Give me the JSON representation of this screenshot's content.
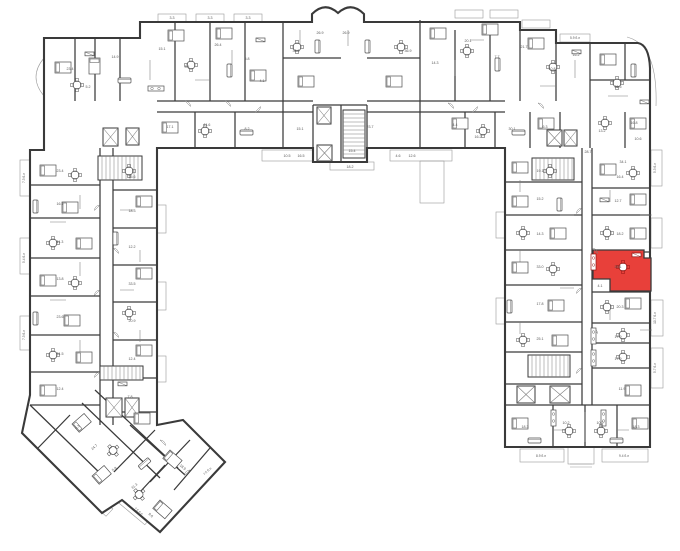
{
  "plan": {
    "name": "floor-plan-level",
    "background": "#ffffff",
    "wall_color": "#3a3a3a",
    "partition_color": "#7c7c7c",
    "thin_color": "#9a9a9a",
    "furniture_color": "#4f4f4f",
    "label_color": "#565656",
    "highlight_color": "#e8403a",
    "highlight_dark_color": "#8f1210",
    "highlighted_unit": {
      "wing": "right",
      "area_label": "26.1",
      "second_label": "4.1"
    }
  },
  "area_labels": [
    {
      "x": 115,
      "y": 58,
      "t": "14.9"
    },
    {
      "x": 70,
      "y": 70,
      "t": "23.4"
    },
    {
      "x": 88,
      "y": 88,
      "t": "5.2"
    },
    {
      "x": 162,
      "y": 50,
      "t": "15.1"
    },
    {
      "x": 187,
      "y": 68,
      "t": "3.4"
    },
    {
      "x": 218,
      "y": 46,
      "t": "26.4"
    },
    {
      "x": 247,
      "y": 60,
      "t": "5.8"
    },
    {
      "x": 262,
      "y": 82,
      "t": "4.1"
    },
    {
      "x": 296,
      "y": 52,
      "t": "36.9"
    },
    {
      "x": 320,
      "y": 34,
      "t": "26.9"
    },
    {
      "x": 346,
      "y": 34,
      "t": "26.9"
    },
    {
      "x": 408,
      "y": 52,
      "t": "36.9"
    },
    {
      "x": 435,
      "y": 64,
      "t": "14.3"
    },
    {
      "x": 468,
      "y": 42,
      "t": "20.1"
    },
    {
      "x": 497,
      "y": 58,
      "t": "7.7"
    },
    {
      "x": 524,
      "y": 48,
      "t": "21.7"
    },
    {
      "x": 552,
      "y": 70,
      "t": "10.8"
    },
    {
      "x": 576,
      "y": 56,
      "t": "16.2"
    },
    {
      "x": 618,
      "y": 88,
      "t": "36.5"
    },
    {
      "x": 170,
      "y": 128,
      "t": "17.1"
    },
    {
      "x": 207,
      "y": 126,
      "t": "11.6"
    },
    {
      "x": 247,
      "y": 130,
      "t": "8.2"
    },
    {
      "x": 300,
      "y": 130,
      "t": "15.1"
    },
    {
      "x": 370,
      "y": 128,
      "t": "23.7"
    },
    {
      "x": 352,
      "y": 152,
      "t": "15.4"
    },
    {
      "x": 350,
      "y": 168,
      "t": "18.2"
    },
    {
      "x": 455,
      "y": 126,
      "t": "4.4"
    },
    {
      "x": 478,
      "y": 138,
      "t": "16.2"
    },
    {
      "x": 512,
      "y": 130,
      "t": "30.1"
    },
    {
      "x": 545,
      "y": 128,
      "t": "6.3"
    },
    {
      "x": 602,
      "y": 132,
      "t": "13.2"
    },
    {
      "x": 634,
      "y": 124,
      "t": "16.8"
    },
    {
      "x": 638,
      "y": 140,
      "t": "10.6"
    },
    {
      "x": 287,
      "y": 157,
      "t": "10.5"
    },
    {
      "x": 301,
      "y": 157,
      "t": "16.5"
    },
    {
      "x": 398,
      "y": 157,
      "t": "4.6"
    },
    {
      "x": 412,
      "y": 157,
      "t": "12.6"
    },
    {
      "x": 60,
      "y": 172,
      "t": "23.4"
    },
    {
      "x": 60,
      "y": 205,
      "t": "16.1"
    },
    {
      "x": 60,
      "y": 243,
      "t": "11.3"
    },
    {
      "x": 60,
      "y": 280,
      "t": "13.8"
    },
    {
      "x": 60,
      "y": 318,
      "t": "23.6"
    },
    {
      "x": 60,
      "y": 355,
      "t": "31.5"
    },
    {
      "x": 60,
      "y": 390,
      "t": "12.4"
    },
    {
      "x": 132,
      "y": 178,
      "t": "15.6"
    },
    {
      "x": 132,
      "y": 212,
      "t": "18.3"
    },
    {
      "x": 132,
      "y": 248,
      "t": "12.2"
    },
    {
      "x": 132,
      "y": 285,
      "t": "33.5"
    },
    {
      "x": 132,
      "y": 322,
      "t": "20.9"
    },
    {
      "x": 132,
      "y": 360,
      "t": "12.4"
    },
    {
      "x": 130,
      "y": 398,
      "t": "7.8"
    },
    {
      "x": 540,
      "y": 172,
      "t": "19.1"
    },
    {
      "x": 540,
      "y": 200,
      "t": "15.2"
    },
    {
      "x": 540,
      "y": 235,
      "t": "14.3"
    },
    {
      "x": 540,
      "y": 268,
      "t": "33.0"
    },
    {
      "x": 540,
      "y": 305,
      "t": "17.8"
    },
    {
      "x": 540,
      "y": 340,
      "t": "25.1"
    },
    {
      "x": 588,
      "y": 153,
      "t": "28.7"
    },
    {
      "x": 623,
      "y": 163,
      "t": "34.1"
    },
    {
      "x": 620,
      "y": 178,
      "t": "16.4"
    },
    {
      "x": 618,
      "y": 202,
      "t": "12.7"
    },
    {
      "x": 620,
      "y": 235,
      "t": "18.2"
    },
    {
      "x": 618,
      "y": 268,
      "t": "26.1",
      "c": "h"
    },
    {
      "x": 600,
      "y": 287,
      "t": "4.1",
      "c": "h"
    },
    {
      "x": 620,
      "y": 308,
      "t": "20.3"
    },
    {
      "x": 618,
      "y": 338,
      "t": "17.9"
    },
    {
      "x": 618,
      "y": 360,
      "t": "17.9"
    },
    {
      "x": 622,
      "y": 390,
      "t": "11.9"
    },
    {
      "x": 525,
      "y": 428,
      "t": "18.3"
    },
    {
      "x": 566,
      "y": 424,
      "t": "10.2"
    },
    {
      "x": 600,
      "y": 424,
      "t": "10.2"
    },
    {
      "x": 636,
      "y": 428,
      "t": "18.3"
    },
    {
      "x": 95,
      "y": 448,
      "t": "24.7",
      "r": -41
    },
    {
      "x": 135,
      "y": 487,
      "t": "31.3",
      "r": -41
    },
    {
      "x": 182,
      "y": 468,
      "t": "18.9",
      "r": 41
    },
    {
      "x": 78,
      "y": 428,
      "t": "6.3",
      "r": -41
    },
    {
      "x": 150,
      "y": 516,
      "t": "9.6",
      "r": 41
    },
    {
      "x": 115,
      "y": 470,
      "t": "5.8",
      "r": -41
    },
    {
      "x": 25,
      "y": 178,
      "t": "7.3 б.л",
      "r": -90
    },
    {
      "x": 25,
      "y": 258,
      "t": "5.4 б.л",
      "r": -90
    },
    {
      "x": 25,
      "y": 335,
      "t": "7.3 б.л",
      "r": -90
    },
    {
      "x": 656,
      "y": 168,
      "t": "5.3 б.л",
      "r": -90
    },
    {
      "x": 656,
      "y": 318,
      "t": "10.7 б.л",
      "r": -90
    },
    {
      "x": 656,
      "y": 368,
      "t": "5.7 б.л",
      "r": -90
    },
    {
      "x": 541,
      "y": 457,
      "t": "8.9 б.л"
    },
    {
      "x": 624,
      "y": 457,
      "t": "9.4 б.л"
    },
    {
      "x": 575,
      "y": 39,
      "t": "5.9 б.л"
    },
    {
      "x": 172,
      "y": 19,
      "t": "3.3"
    },
    {
      "x": 210,
      "y": 19,
      "t": "3.3"
    },
    {
      "x": 248,
      "y": 19,
      "t": "3.3"
    },
    {
      "x": 208,
      "y": 472,
      "t": "7.5 б.л",
      "r": -42
    },
    {
      "x": 138,
      "y": 512,
      "t": "7.5 б.л",
      "r": 40
    }
  ]
}
